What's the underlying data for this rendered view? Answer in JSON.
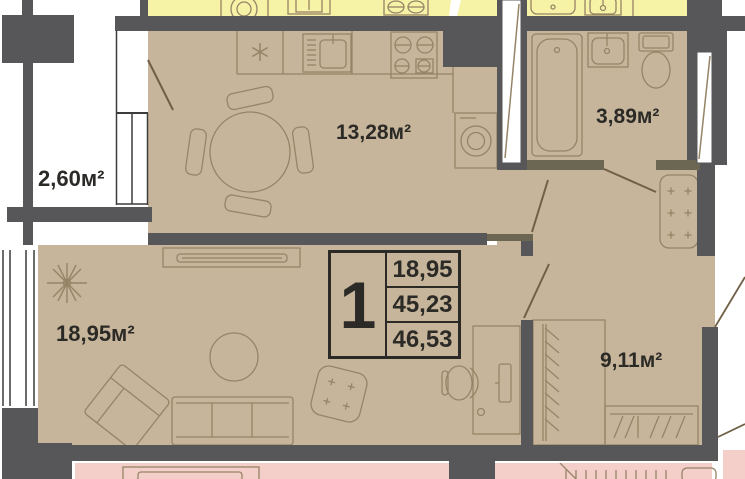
{
  "floor_plan": {
    "unit_card": {
      "number": "1",
      "values": [
        "18,95",
        "45,23",
        "46,53"
      ]
    },
    "rooms": {
      "balcony": "2,60м²",
      "kitchen": "13,28м²",
      "bathroom": "3,89м²",
      "living": "18,95м²",
      "bedroom": "9,11м²"
    },
    "colors": {
      "walls": "#57575a",
      "unit_fill": "#c6b59b",
      "furniture_line": "#968467",
      "neighbor_unit_top": "#f6f2a6",
      "neighbor_unit_bottom": "#f4cfc9",
      "text": "#2b2a26"
    }
  }
}
